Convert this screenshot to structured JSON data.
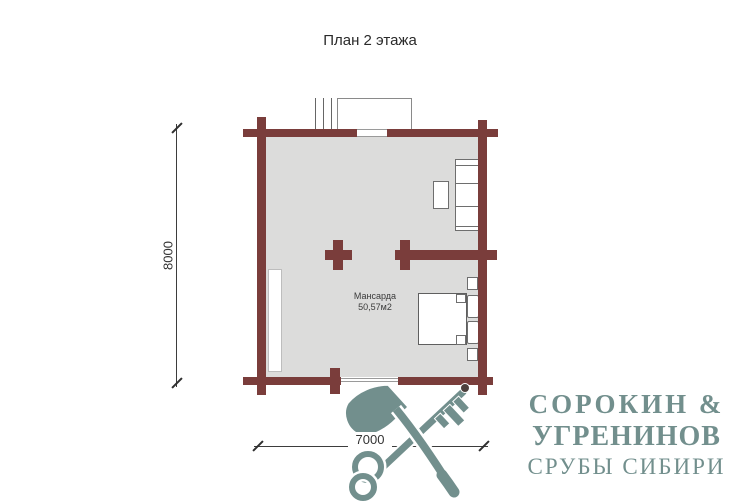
{
  "title": "План 2 этажа",
  "plan": {
    "room": {
      "name": "Мансарда",
      "area": "50,57м2"
    },
    "dimensions": {
      "height": "8000",
      "width": "7000"
    }
  },
  "logo": {
    "line1": "СОРОКИН &",
    "line2": "УГРЕНИНОВ",
    "line3": "СРУБЫ СИБИРИ"
  },
  "icons": {
    "emblem": "axe-and-key-icon"
  },
  "colors": {
    "wall": "#7a3d3b",
    "floor": "#dcdcdb",
    "furniture-outline": "#6e6e6e",
    "thin-line": "#8a8a8a",
    "dim-line": "#3d3d3d",
    "text": "#2a2a2a",
    "logo": "#728f8d"
  }
}
